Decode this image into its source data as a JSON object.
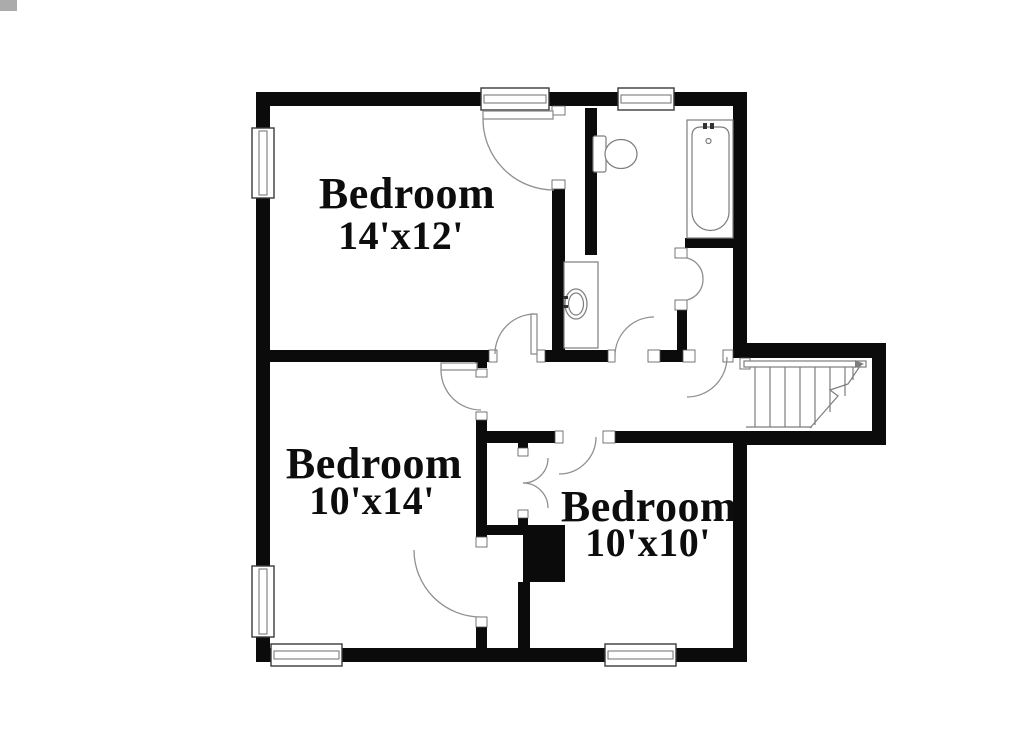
{
  "rooms": [
    {
      "id": "bedroom-14x12",
      "name": "Bedroom",
      "dimensions": "14'x12'"
    },
    {
      "id": "bedroom-10x14",
      "name": "Bedroom",
      "dimensions": "10'x14'"
    },
    {
      "id": "bedroom-10x10",
      "name": "Bedroom",
      "dimensions": "10'x10'"
    }
  ],
  "fixtures": [
    "bathtub",
    "toilet",
    "sink-vanity",
    "staircase",
    "chimney"
  ],
  "colors": {
    "wall": "#0b0b0b",
    "fixture_line": "#7d7d7d",
    "door_arc": "#8f8f8f",
    "window_frame": "#3a3a3a",
    "background": "#ffffff",
    "text": "#0d0d0d"
  }
}
